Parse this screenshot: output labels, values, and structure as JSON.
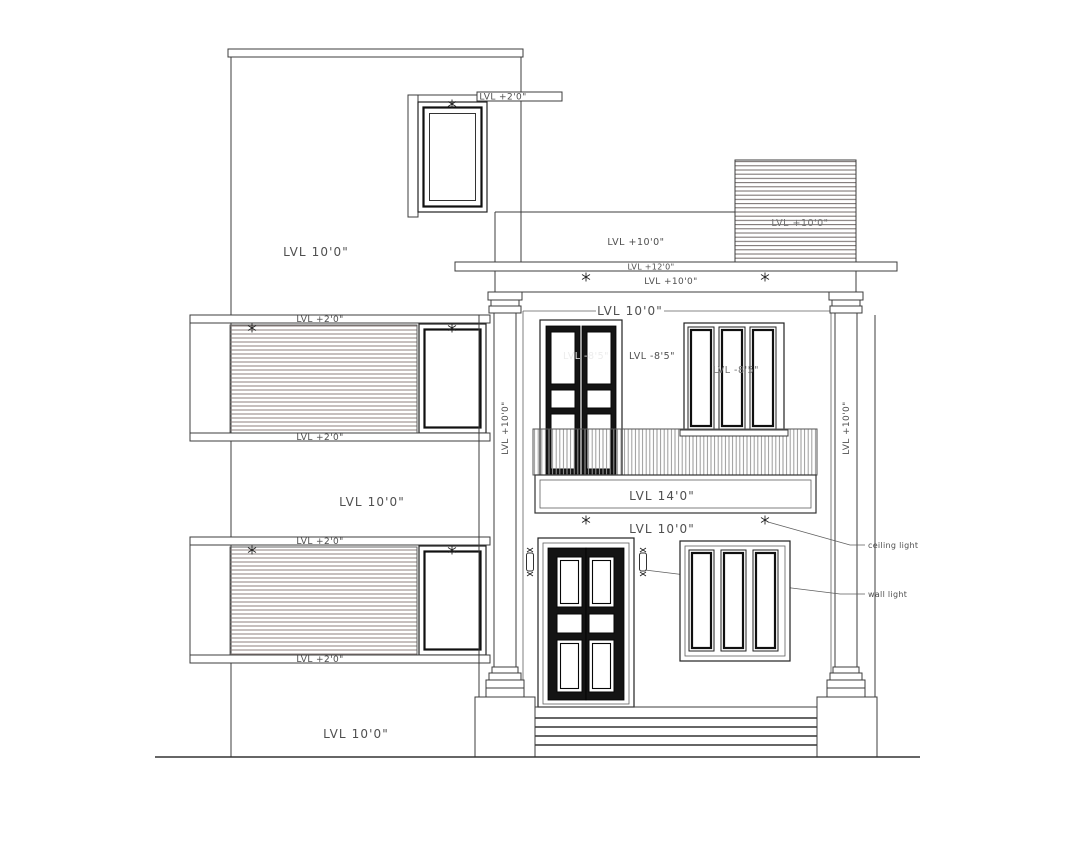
{
  "title": "House front elevation drawing",
  "levels": {
    "plus_2_0": "LVL +2'0\"",
    "ten_0": "LVL 10'0\"",
    "plus_10_0": "LVL +10'0\"",
    "plus_12_0": "LVL +12'0\"",
    "fourteen_0": "LVL 14'0\"",
    "minus_8_5": "LVL -8'5\""
  },
  "annotations": {
    "ceiling_light": "ceiling light",
    "wall_light": "wall light"
  },
  "colors": {
    "background": "#ffffff",
    "line": "#3c3c3c",
    "frame_dark": "#1a1a1a",
    "door_fill": "#141414",
    "hatch_brown": "#8d7f7c",
    "hatch_dark": "#716a68",
    "hatch_gray": "#9a9a9a",
    "text": "#4f4f4f"
  }
}
